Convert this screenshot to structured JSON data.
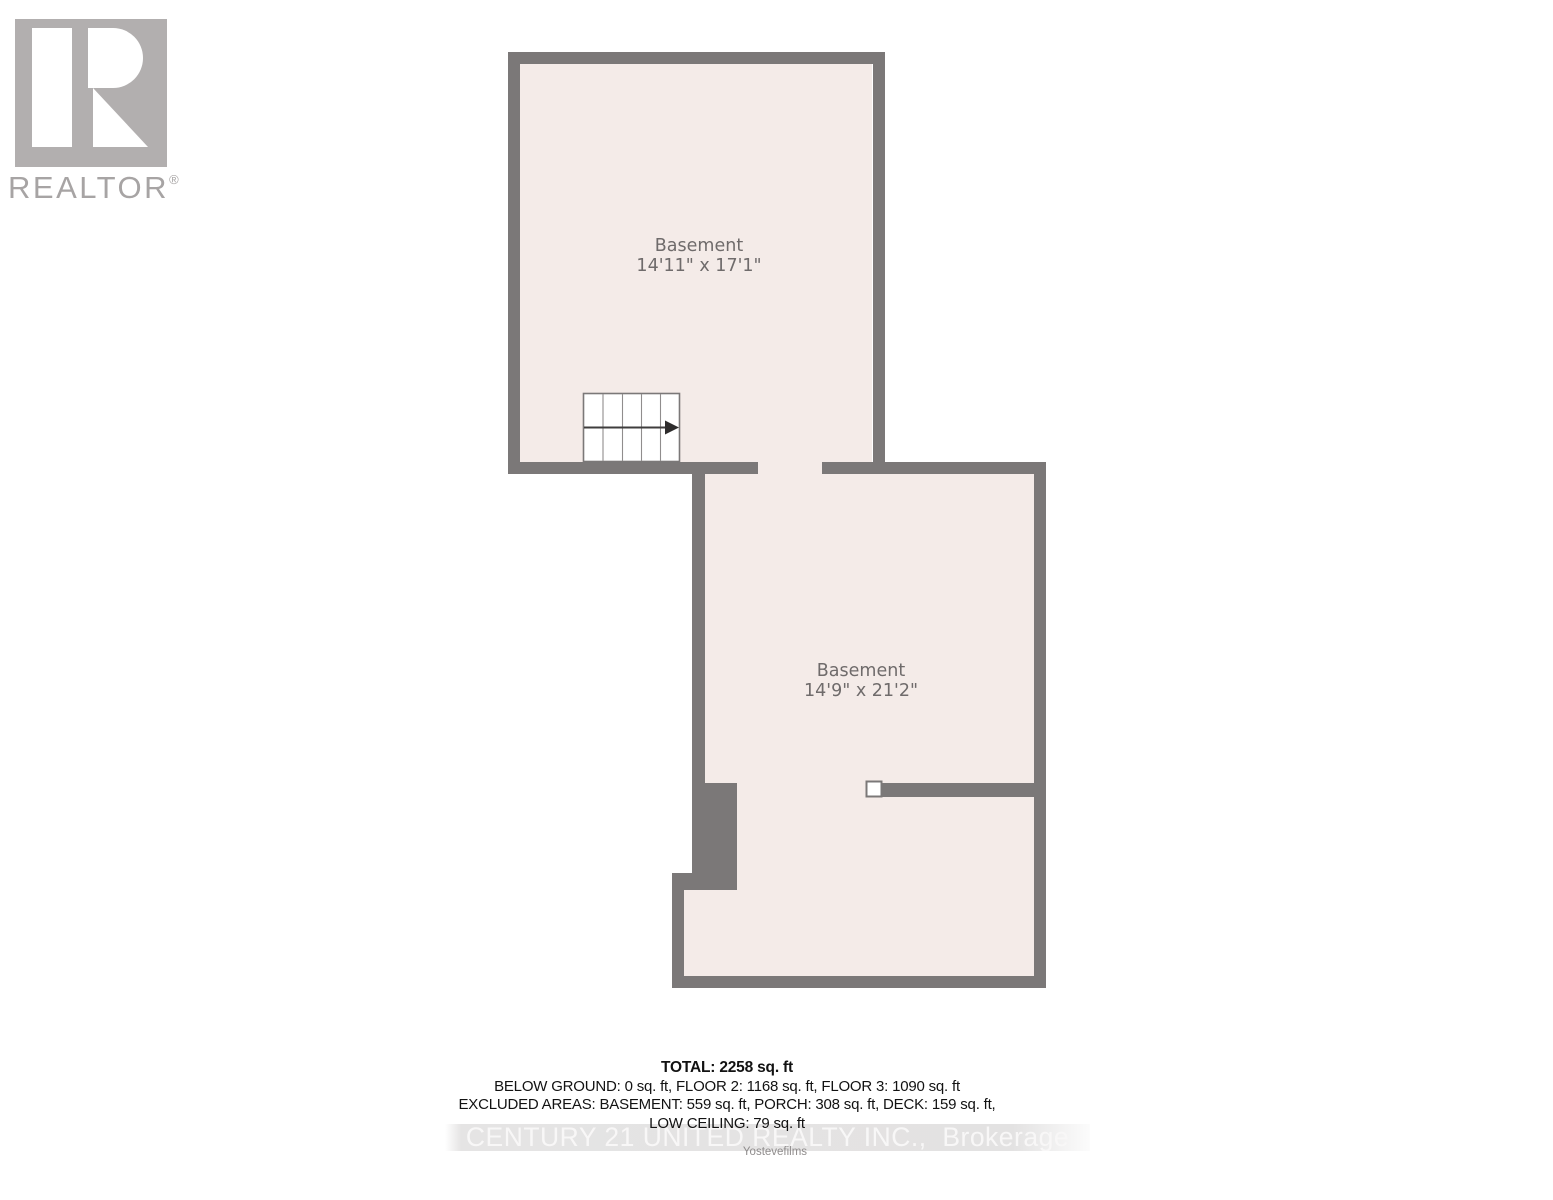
{
  "logo": {
    "name": "REALTOR",
    "reg": "®"
  },
  "rooms": {
    "upper": {
      "name": "Basement",
      "dims": "14'11\" x 17'1\""
    },
    "lower": {
      "name": "Basement",
      "dims": "14'9\" x 21'2\""
    }
  },
  "summary": {
    "total": "TOTAL: 2258 sq. ft",
    "line1": "BELOW GROUND: 0 sq. ft, FLOOR 2: 1168 sq. ft, FLOOR 3: 1090 sq. ft",
    "line2": "EXCLUDED AREAS: BASEMENT: 559 sq. ft, PORCH: 308 sq. ft, DECK: 159 sq. ft,",
    "line3": "LOW CEILING: 79 sq. ft"
  },
  "watermark": {
    "brokerage": "CENTURY 21 UNITED REALTY INC.,  Brokerage",
    "credit": "Yostevefilms"
  },
  "colors": {
    "wall": "#7b7878",
    "room_fill": "#f4ebe8",
    "label_text": "#6f6b6b",
    "logo_gray": "#b2afaf",
    "logo_text": "#a7a4a4",
    "watermark_band": "#e3e2e2",
    "watermark_text": "#f8f7f7",
    "stairs_arrow": "#2e2c2c"
  }
}
